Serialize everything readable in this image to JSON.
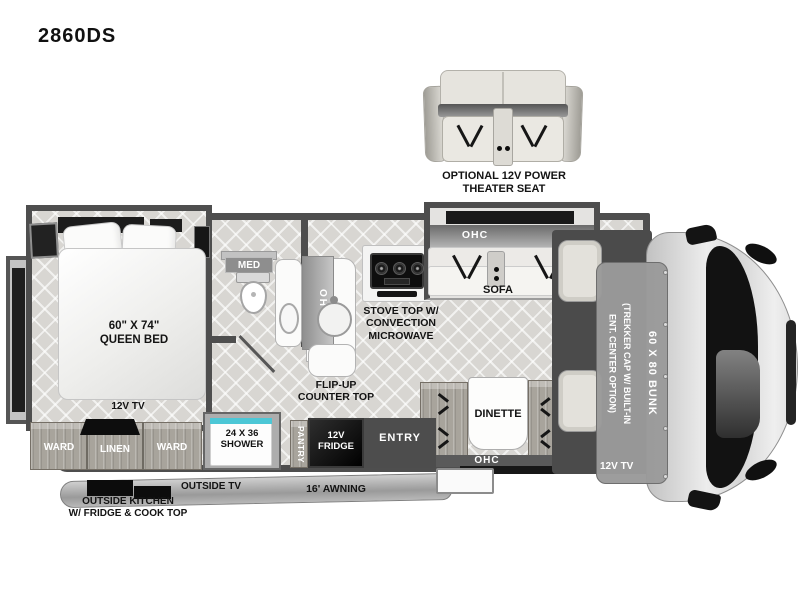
{
  "title": "2860DS",
  "theater": {
    "label": "OPTIONAL 12V POWER\nTHEATER SEAT"
  },
  "bedroom": {
    "bed": "60\" X 74\"\nQUEEN BED",
    "tv": "12V TV",
    "ward_l": "WARD",
    "linen": "LINEN",
    "ward_r": "WARD"
  },
  "bath": {
    "med": "MED",
    "shower": "24 X 36\nSHOWER"
  },
  "kitchen": {
    "ohc": "OHC",
    "stove": "STOVE TOP W/\nCONVECTION\nMICROWAVE",
    "flip": "FLIP-UP\nCOUNTER TOP",
    "pantry": "PANTRY",
    "fridge": "12V\nFRIDGE"
  },
  "living": {
    "sofa_ohc": "OHC",
    "sofa": "SOFA",
    "dinette": "DINETTE",
    "dinette_ohc": "OHC",
    "entry": "ENTRY"
  },
  "cab": {
    "bunk": "60 X 80 BUNK",
    "trekker": "(TREKKER CAP W/ BUILT-IN\nENT. CENTER OPTION)",
    "tv": "12V TV"
  },
  "exterior": {
    "outside_tv": "OUTSIDE TV",
    "outside_kitchen": "OUTSIDE KITCHEN\nW/ FRIDGE & COOK TOP",
    "awning": "16' AWNING"
  },
  "colors": {
    "wall": "#4e4e4e",
    "floor": "#d8d6d2",
    "wood": "#a8a49c",
    "shower_glass": "#4cc7d6",
    "appliance_black": "#111111"
  }
}
